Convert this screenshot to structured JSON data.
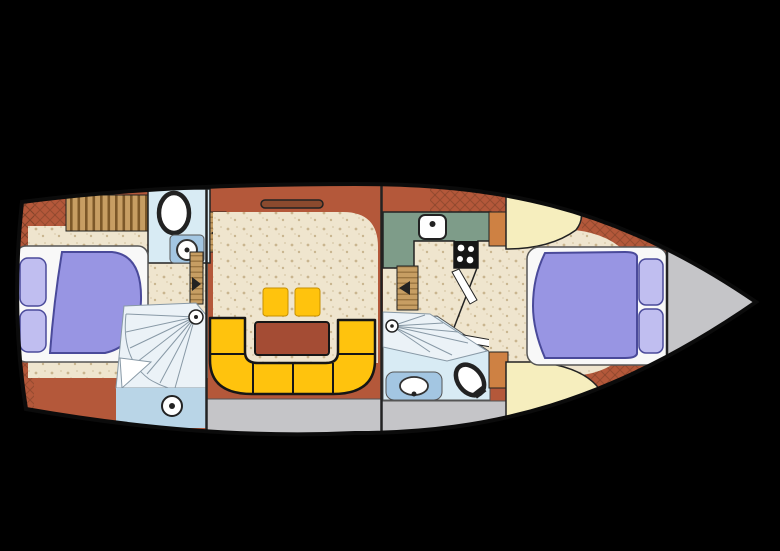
{
  "figure": {
    "kind": "boat-deck-floor-plan",
    "orientation": "bow-right"
  },
  "colors": {
    "background": "#000000",
    "hull_outline": "#0b0b0b",
    "terracotta": "#B4583A",
    "hatch_slot_brown": "#8A4A2E",
    "brick_hatch_line": "#6E3A22",
    "floor_beige": "#EFE5CE",
    "floor_speckle": "#C9B58F",
    "floor_speckle_light": "#DCCEAF",
    "bed_purple": "#9895E3",
    "pillow_purple": "#C0BEF0",
    "bed_outline": "#4A4A9A",
    "bed_frame_white": "#F8F8F8",
    "sofa_yellow": "#FFC30D",
    "sofa_outline": "#161616",
    "stool_edge": "#C79000",
    "table_brown": "#A44C34",
    "galley_green": "#7E9C89",
    "stove_black": "#161616",
    "wood_tan": "#C79E63",
    "wood_grain": "#6E4B1E",
    "orange_cabinet": "#CE8143",
    "cream_seat": "#F6EEBE",
    "room_lightblue": "#D8EBF4",
    "stairs_lightblue": "#EBF2F7",
    "water_blue": "#B9D5E7",
    "vanity_blue": "#A3C6E2",
    "sink_ring": "#333333",
    "deck_gray": "#C5C5C8",
    "line_dark": "#222222",
    "line_mid": "#555555",
    "ray_gray": "#8899A6",
    "white": "#FFFFFF"
  }
}
